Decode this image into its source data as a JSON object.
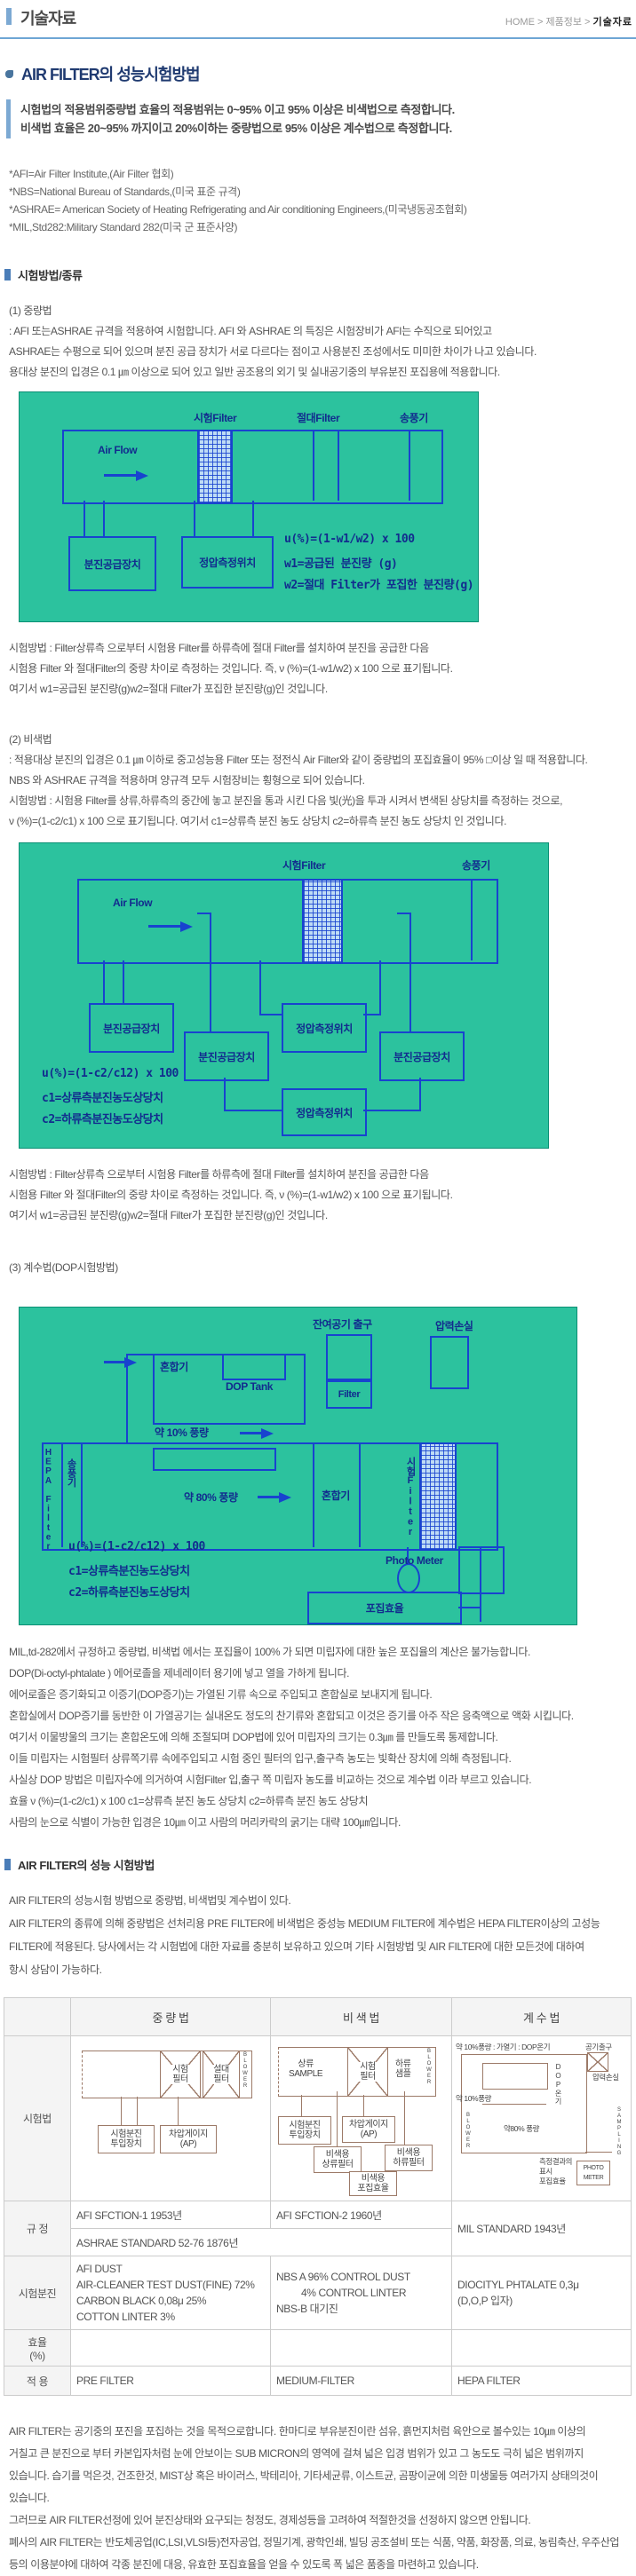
{
  "header": {
    "title": "기술자료",
    "breadcrumb": {
      "home": "HOME",
      "mid": "제품정보",
      "current": "기술자료"
    }
  },
  "intro": {
    "heading": "AIR FILTER의 성능시험방법",
    "line1": "시험법의 적용범위중량법 효율의 적용범위는 0~95% 이고 95% 이상은 비색법으로 측정합니다.",
    "line2": "비색법 효율은 20~95% 까지이고 20%이하는 중량법으로 95% 이상은 계수법으로 측정합니다.",
    "notes": [
      "*AFI=Air Filter Institute,(Air Filter 협회)",
      "*NBS=National Bureau of Standards,(미국 표준 규격)",
      "*ASHRAE= American Society of Heating Refrigerating and Air conditioning Engineers,(미국냉동공조협회)",
      "*MIL,Std282:Military Standard 282(미국 군 표준사양)"
    ]
  },
  "sec1": {
    "title": "시험방법/종류",
    "m1_title": "(1) 중량법",
    "m1_lines": [
      ": AFI 또는ASHRAE 규격을 적용하여 시험합니다. AFI 와 ASHRAE 의 특징은 시험장비가 AFI는 수직으로 되어있고",
      "ASHRAE는 수평으로 되어 있으며 분진 공급 장치가 서로 다르다는 점이고 사용분진 조성에서도 미미한 차이가 나고 있습니다.",
      "용대상 분진의 입경은 0.1 ㎛ 이상으로 되어 있고 일반 공조용의 외기 및 실내공기중의 부유분진 포집용에 적용합니다."
    ],
    "result_lines": [
      "시험방법 : Filter상류측 으로부터 시험용 Filter를 하류측에 절대 Filter를 설치하여 분진을 공급한 다음",
      "시험용 Filter 와 절대Filter의 중량 차이로 측정하는 것입니다. 즉, ν (%)=(1-w1/w2) x 100 으로 표기됩니다.",
      "여기서 w1=공급된 분진량(g)w2=절대 Filter가 포집한 분진량(g)인 것입니다."
    ],
    "m2_title": "(2) 비색법",
    "m2_lines": [
      ": 적용대상 분진의 입경은 0.1 ㎛ 이하로 중고성능용 Filter 또는 정전식 Air Filter와 같이 중량법의 포집효율이 95% □이상 일 때 적용합니다.",
      "NBS 와 ASHRAE 규격을 적용하며 양규격 모두 시험장비는 횡형으로 되어 있습니다.",
      "시험방법 : 시험용 Filter를 상류,하류측의 중간에 놓고 분진을 통과 시킨 다음 빛(光)을 투과 시켜서 변색된 상당치를 측정하는 것으로,",
      "ν (%)=(1-c2/c1) x 100 으로 표기됩니다. 여기서 c1=상류측 분진 농도 상당치 c2=하류측 분진 농도 상당치 인 것입니다."
    ],
    "m3_title": "(3) 계수법(DOP시험방법)",
    "dop_lines": [
      "MIL,td-282에서 규정하고 중량법, 비색법 에서는 포집율이 100% 가 되면 미립자에 대한 높은 포집율의 계산은 불가능합니다.",
      "DOP(Di-octyl-phtalate ) 에어로졸을 제네레이터 용기에 넣고 열을 가하게 됩니다.",
      "에어로졸은 증기화되고 이증기(DOP증기)는 가열된 기류 속으로 주입되고 혼합실로 보내지게 됩니다.",
      "혼합실에서 DOP증기를 동반한 이 가열공기는 실내온도 정도의 찬기류와 혼합되고 이것은 증기를 아주 작은 응축액으로 액화 시킵니다.",
      "여기서 이물방울의 크기는 혼합온도에 의해 조절되며 DOP법에 있어 미립자의 크기는 0.3㎛ 를 만들도록 통제합니다.",
      "이들 미립자는 시험필터 상류쪽기류 속에주입되고 시험 중인 필터의 입구,출구측 농도는 빛확산 장치에 의해 측정됩니다.",
      "사실상 DOP 방법은 미립자수에 의거하여 시험Filter 입,출구 쪽 미립자 농도를 비교하는 것으로 계수법 이라 부르고 있습니다.",
      "효율 ν (%)=(1-c2/c1) x 100 c1=상류측 분진 농도 상당치 c2=하류측 분진 농도 상당치",
      "사람의 눈으로 식별이 가능한 입경은 10㎛ 이고 사람의 머리카락의 굵기는 대략 100㎛입니다."
    ]
  },
  "d1": {
    "f_test": "시험Filter",
    "f_abs": "절대Filter",
    "fan": "송풍기",
    "airflow": "Air Flow",
    "box_supply": "분진공급장치",
    "box_static": "정압측정위치",
    "formula": [
      "u(%)=(1-w1/w2) x 100",
      "w1=공급된 분진량 (g)",
      "w2=절대 Filter가 포집한 분진량(g)"
    ]
  },
  "d2": {
    "f_test": "시험Filter",
    "fan": "송풍기",
    "airflow": "Air Flow",
    "box_supply": "분진공급장치",
    "box_static": "정압측정위치",
    "formula": [
      "u(%)=(1-c2/c12) x 100",
      "c1=상류측분진농도상당치",
      "c2=하류측분진농도상당치"
    ]
  },
  "d3": {
    "exhaust": "잔여공기 출구",
    "ploss": "압력손실",
    "mixer": "혼합기",
    "dop_tank": "DOP Tank",
    "filter": "Filter",
    "ten": "약 10% 풍량",
    "hepa": "HEPA Filter",
    "fan": "송풍기",
    "eighty": "약 80% 풍량",
    "mixer2": "혼합기",
    "f_test": "시험Filter",
    "photo": "Photo Meter",
    "eff": "포집효율",
    "formula": [
      "u(%)=(1-c2/c12) x 100",
      "c1=상류측분진농도상당치",
      "c2=하류측분진농도상당치"
    ]
  },
  "sec2": {
    "title": "AIR FILTER의 성능 시험방법",
    "lines": [
      "AIR FILTER의 성능시험 방법으로 중량법, 비색법및 계수법이 있다.",
      "AIR FILTER의 종류에 의해 중량법은 선처리용 PRE FILTER에 비색법은 중성능 MEDIUM FILTER에 계수법은 HEPA FILTER이상의 고성능",
      "FILTER에 적용된다. 당사에서는 각 시험법에 대한 자료를 충분히 보유하고 있으며 기타 시험방법 및 AIR FILTER에 대한 모든것에 대하여",
      "항시 상담이 가능하다."
    ]
  },
  "table": {
    "col_weight": "중 량 법",
    "col_color": "비 색 법",
    "col_count": "계 수 법",
    "row_method": "시험법",
    "row_std": "규 정",
    "row_dust": "시험분진",
    "row_eff": "효율\n(%)",
    "row_apply": "적 용",
    "std_w": "AFI SFCTION-1 1953년",
    "std_c": "AFI SFCTION-2 1960년",
    "std_shared": "ASHRAE STANDARD 52-76 1876년",
    "std_n": "MIL STANDARD 1943년",
    "dust_w": [
      "AFI DUST",
      "AIR-CLEANER TEST DUST(FINE) 72%",
      "CARBON BLACK 0,08μ 25%",
      "COTTON LINTER 3%"
    ],
    "dust_c": [
      "NBS A 96% CONTROL DUST",
      "4% CONTROL LINTER",
      "NBS-B 대기진"
    ],
    "dust_n": [
      "DIOCITYL PHTALATE 0,3μ",
      "(D,O,P 입자)"
    ],
    "apply_w": "PRE FILTER",
    "apply_c": "MEDIUM-FILTER",
    "apply_n": "HEPA FILTER",
    "mini_w": {
      "f1": "시험\n필터",
      "f2": "설대\n필터",
      "blower": "BLOWER",
      "b1": "시험분진\n투입장치",
      "b2": "차압게이지\n(AP)"
    },
    "mini_c": {
      "up": "상류\nSAMPLE",
      "f": "시험\n필터",
      "down": "하류\n샘플",
      "blower": "BLOWER",
      "b1": "시험분진\n투입장치",
      "b2": "차압게이지\n(AP)",
      "b3": "비색용\n상류필터",
      "b4": "비색용\n하류필터",
      "b5": "비색용\n포집효율"
    },
    "mini_n": {
      "top": "약 10%풍량 : 가열기 : DOP온기",
      "airout": "공기출구",
      "ploss": "압력손실",
      "dop": "DOP온기",
      "ten": "약 10%풍량",
      "blower": "BLOWER",
      "eighty": "약80% 풍량",
      "sampling": "SAMPLING",
      "result": "측정결과의\n표시\n포집효율",
      "photo": "PHOTO\nMETER"
    }
  },
  "outro": {
    "lines": [
      "AIR FILTER는 공기중의 포진을 포집하는 것을 목적으로합니다. 한마디로 부유분진이란 섬유, 흙먼지처럼 육안으로 볼수있는 10㎛ 이상의",
      "거칠고 큰 분진으로 부터 카본입자처럼 눈에 안보이는 SUB MICRON의 영역에 걸쳐 넓은 입경 범위가 있고 그 농도도 극히 넓은 범위까지",
      "있습니다. 습기를 먹은것, 건조한것, MIST상 혹은 바이러스, 박테리아, 기타세균류, 이스트균, 곰팡이균에 의한 미생물등 여러가지 상태의것이",
      "있습니다.",
      "그러므로 AIR FILTER선정에 있어 분진상태와 요구되는 청정도, 경제성등을 고려하여 적절한것을 선정하지 않으면 안됩니다.",
      "폐사의 AIR FILTER는 반도체공업(IC,LSI,VLSI등)전자공업, 정밀기계, 광학인쇄, 빌딩 공조설비 또는 식품, 약품, 화장품, 의료, 농림축산, 우주산업",
      "등의 이용분야에 대하여 각종 분진에 대응, 유효한 포집효율을 얻을 수 있도록 폭 넓은 품종을 마련하고 있습니다."
    ]
  }
}
